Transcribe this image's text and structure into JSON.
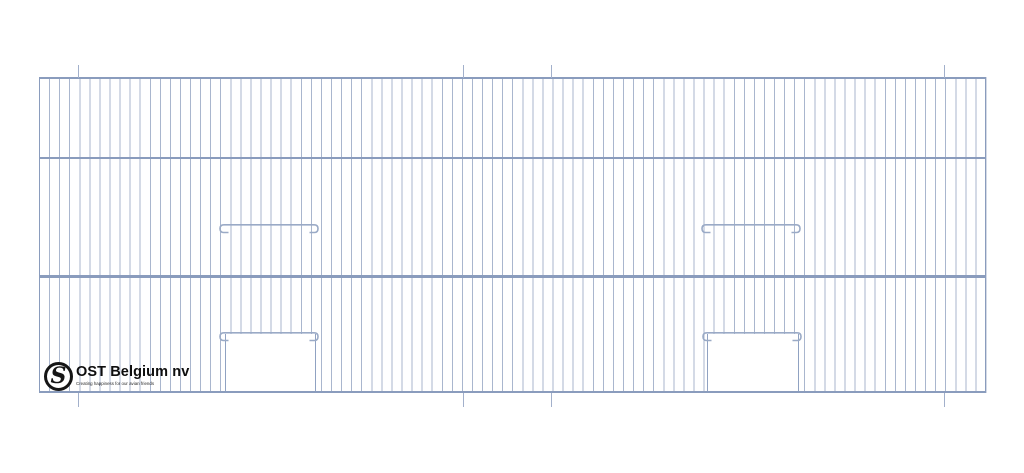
{
  "logo": {
    "monogram": "S",
    "company_name": "OST Belgium nv",
    "tagline": "Creating happiness for our avian friends"
  },
  "drawing": {
    "subject": "wire mesh cage front panel",
    "horizontal_rails": 4,
    "mesh_sections": 3,
    "door_openings": 2,
    "hook_rails": 4,
    "bend_marks_top": 4,
    "bend_marks_bottom": 4
  },
  "colors": {
    "wire": "#a9b6ce",
    "frame": "#8a9cbd",
    "hook": "#9aaac6",
    "tick": "#a2b0cb",
    "door-edge": "#90a2c2",
    "logo-ink": "#161616"
  }
}
